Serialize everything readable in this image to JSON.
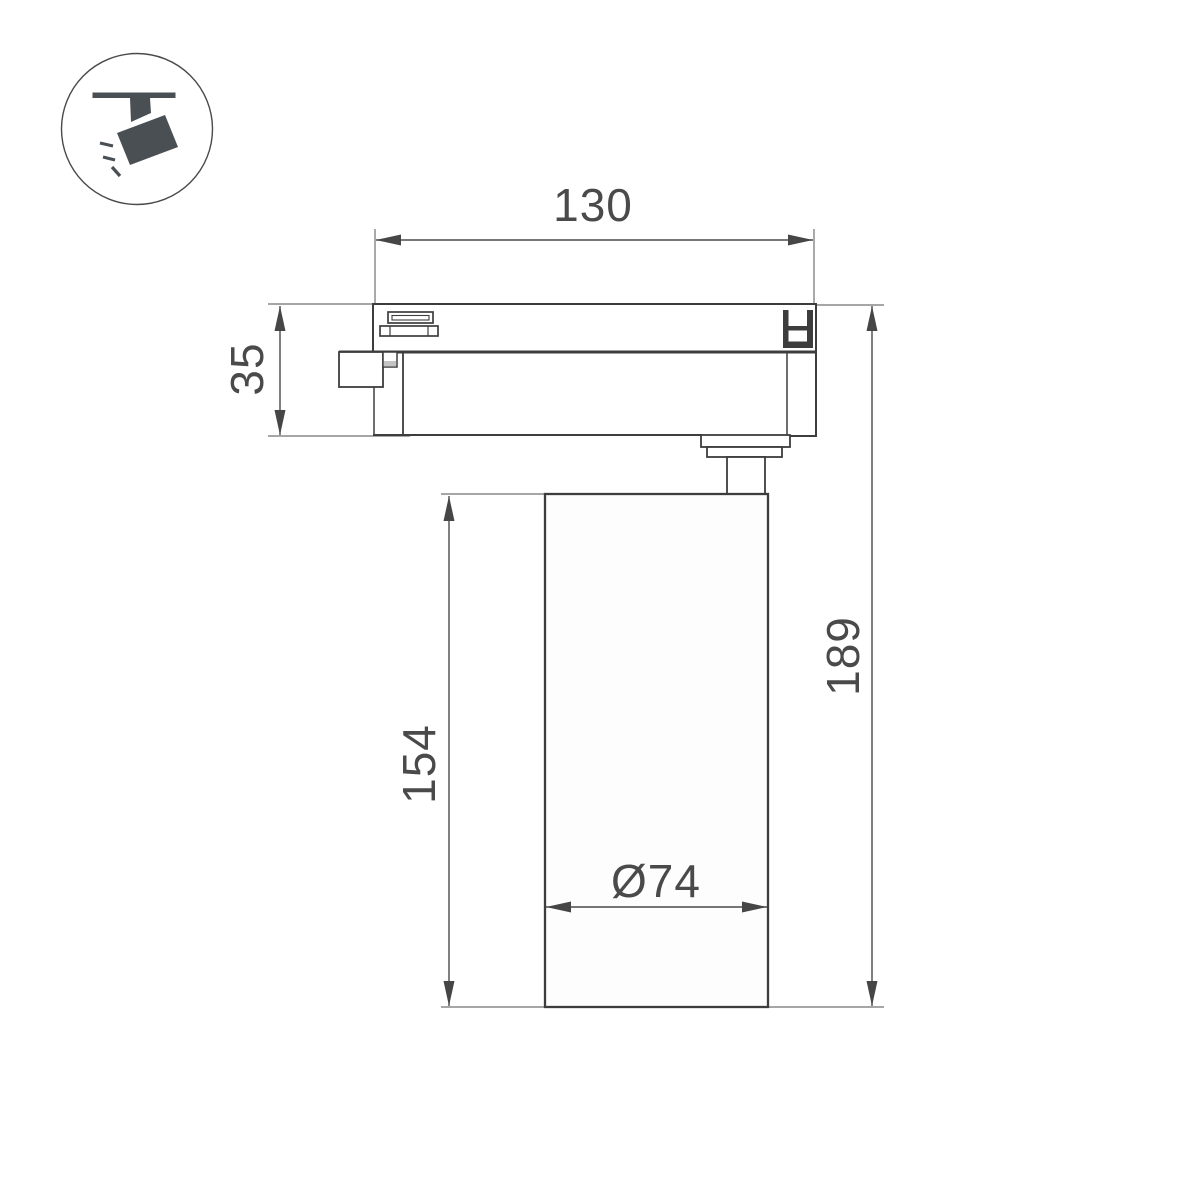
{
  "icon": {
    "name": "track-spotlight-icon"
  },
  "dimensions": {
    "track_width": "130",
    "adapter_height": "35",
    "body_height": "154",
    "total_height": "189",
    "diameter": "Ø74"
  },
  "colors": {
    "outline": "#3d3d3d",
    "dimension_line": "#4a4a4a",
    "extension_line": "#707070",
    "icon_fill": "#4a4f54",
    "step_shading": "#c4c4c4",
    "background": "#ffffff"
  }
}
